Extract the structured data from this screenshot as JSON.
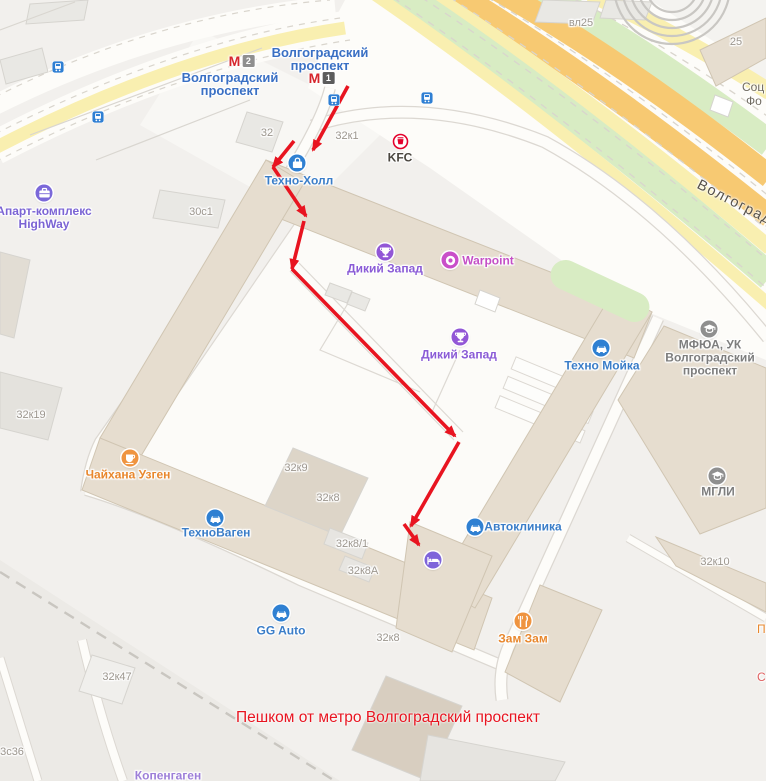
{
  "annotation": {
    "text": "Пешком от метро Волгоградский проспект",
    "x": 388,
    "y": 718,
    "color": "#e81420"
  },
  "road_label": {
    "text": "Волгоградский проспект",
    "x": 698,
    "y": 176,
    "rotate": 27
  },
  "route": {
    "color": "#e81420",
    "segments": [
      [
        348,
        86,
        313,
        150
      ],
      [
        294,
        141,
        273,
        167
      ],
      [
        273,
        167,
        306,
        216
      ],
      [
        304,
        221,
        292,
        269
      ],
      [
        292,
        269,
        455,
        436
      ],
      [
        459,
        442,
        411,
        526
      ],
      [
        404,
        524,
        419,
        545
      ]
    ]
  },
  "metro_stations": [
    {
      "id": "volgogradskiy-prospekt-l2",
      "badge": "2",
      "badge_color": "#8f8f8f",
      "icon_x": 242,
      "icon_y": 61,
      "label_lines": [
        "Волгоградский",
        "проспект"
      ],
      "label_x": 230,
      "label_y": 84,
      "label_color": "#3a70c4"
    },
    {
      "id": "volgogradskiy-prospekt-l1",
      "badge": "1",
      "badge_color": "#5c5c5c",
      "icon_x": 322,
      "icon_y": 78,
      "label_lines": [
        "Волгоградский",
        "проспект"
      ],
      "label_x": 320,
      "label_y": 59,
      "label_color": "#3a70c4"
    }
  ],
  "tram_stops": [
    {
      "x": 58,
      "y": 69
    },
    {
      "x": 98,
      "y": 119
    },
    {
      "x": 334,
      "y": 102
    },
    {
      "x": 427,
      "y": 100
    }
  ],
  "pois": [
    {
      "id": "kfc",
      "icon": "kfc",
      "color": "#ffffff",
      "x": 400,
      "y": 141,
      "label": "KFC",
      "lx": 400,
      "ly": 158,
      "label_color": "#4a463f"
    },
    {
      "id": "tehno-holl",
      "icon": "bag",
      "color": "#2f80d2",
      "x": 297,
      "y": 163,
      "label": "Техно-Холл",
      "lx": 299,
      "ly": 181,
      "label_color": "#3a7dc8"
    },
    {
      "id": "dikiy-zapad-1",
      "icon": "trophy",
      "color": "#9257d6",
      "x": 385,
      "y": 252,
      "label": "Дикий Запад",
      "lx": 385,
      "ly": 269,
      "label_color": "#8a5bd6"
    },
    {
      "id": "warpoint",
      "icon": "donut",
      "color": "#c94fc9",
      "x": 450,
      "y": 260,
      "label": "Warpoint",
      "lx": 488,
      "ly": 261,
      "label_color": "#c44fc6"
    },
    {
      "id": "dikiy-zapad-2",
      "icon": "trophy",
      "color": "#9257d6",
      "x": 460,
      "y": 337,
      "label": "Дикий Запад",
      "lx": 459,
      "ly": 355,
      "label_color": "#8a5bd6"
    },
    {
      "id": "tehno-moyka",
      "icon": "car",
      "color": "#2f80d2",
      "x": 601,
      "y": 348,
      "label": "Техно Мойка",
      "lx": 602,
      "ly": 366,
      "label_color": "#3a7dc8"
    },
    {
      "id": "mfua",
      "icon": "cap",
      "color": "#8f8f8f",
      "x": 709,
      "y": 329,
      "label": "МФЮА, УК\nВолгоградский\nпроспект",
      "lx": 710,
      "ly": 358,
      "label_color": "#7d7d7d"
    },
    {
      "id": "mgli",
      "icon": "cap",
      "color": "#8f8f8f",
      "x": 717,
      "y": 476,
      "label": "МГЛИ",
      "lx": 718,
      "ly": 492,
      "label_color": "#7d7d7d"
    },
    {
      "id": "apart-kompleks-highway",
      "icon": "case",
      "color": "#7b68d9",
      "x": 44,
      "y": 193,
      "label": "Апарт-комплекс\nHighWay",
      "lx": 44,
      "ly": 218,
      "label_color": "#7b64d4"
    },
    {
      "id": "chaihana-uzgen",
      "icon": "cup",
      "color": "#ef9440",
      "x": 130,
      "y": 458,
      "label": "Чайхана Узген",
      "lx": 128,
      "ly": 475,
      "label_color": "#e8872d"
    },
    {
      "id": "tehnovagen",
      "icon": "car",
      "color": "#2f80d2",
      "x": 215,
      "y": 518,
      "label": "ТехноВаген",
      "lx": 216,
      "ly": 533,
      "label_color": "#3a7dc8"
    },
    {
      "id": "avtoklinika",
      "icon": "car",
      "color": "#2f80d2",
      "x": 475,
      "y": 527,
      "label": "Автоклиника",
      "lx": 523,
      "ly": 527,
      "label_color": "#3a7dc8"
    },
    {
      "id": "hotel",
      "icon": "bed",
      "color": "#7e64da",
      "x": 433,
      "y": 560,
      "label": "",
      "lx": 0,
      "ly": 0,
      "label_color": "#7b64d4"
    },
    {
      "id": "zam-zam",
      "icon": "food",
      "color": "#ef9440",
      "x": 523,
      "y": 621,
      "label": "Зам Зам",
      "lx": 523,
      "ly": 639,
      "label_color": "#e8872d"
    },
    {
      "id": "gg-auto",
      "icon": "car",
      "color": "#2f80d2",
      "x": 281,
      "y": 613,
      "label": "GG Auto",
      "lx": 281,
      "ly": 631,
      "label_color": "#3a7dc8"
    },
    {
      "id": "kopengagen",
      "icon": "",
      "color": "",
      "x": 0,
      "y": 0,
      "label": "Копенгаген",
      "lx": 168,
      "ly": 776,
      "label_color": "#9d7fd8"
    }
  ],
  "building_labels": [
    {
      "text": "32",
      "x": 267,
      "y": 133
    },
    {
      "text": "32к1",
      "x": 347,
      "y": 136
    },
    {
      "text": "30с1",
      "x": 201,
      "y": 212
    },
    {
      "text": "32к19",
      "x": 31,
      "y": 415
    },
    {
      "text": "32к9",
      "x": 296,
      "y": 468
    },
    {
      "text": "32к8",
      "x": 328,
      "y": 498
    },
    {
      "text": "32к8/1",
      "x": 352,
      "y": 544
    },
    {
      "text": "32к8А",
      "x": 363,
      "y": 571
    },
    {
      "text": "32к8",
      "x": 388,
      "y": 638
    },
    {
      "text": "32к10",
      "x": 715,
      "y": 562
    },
    {
      "text": "32к47",
      "x": 117,
      "y": 677
    },
    {
      "text": "3с36",
      "x": 12,
      "y": 752
    },
    {
      "text": "вл25",
      "x": 581,
      "y": 23
    },
    {
      "text": "25",
      "x": 736,
      "y": 42
    }
  ],
  "edge_labels": [
    {
      "text": "Соц",
      "x": 742,
      "y": 87,
      "color": "#6f6a60"
    },
    {
      "text": "Фо",
      "x": 746,
      "y": 101,
      "color": "#6f6a60"
    },
    {
      "text": "П",
      "x": 757,
      "y": 629,
      "color": "#e8872d"
    },
    {
      "text": "С",
      "x": 757,
      "y": 677,
      "color": "#e06060"
    }
  ]
}
